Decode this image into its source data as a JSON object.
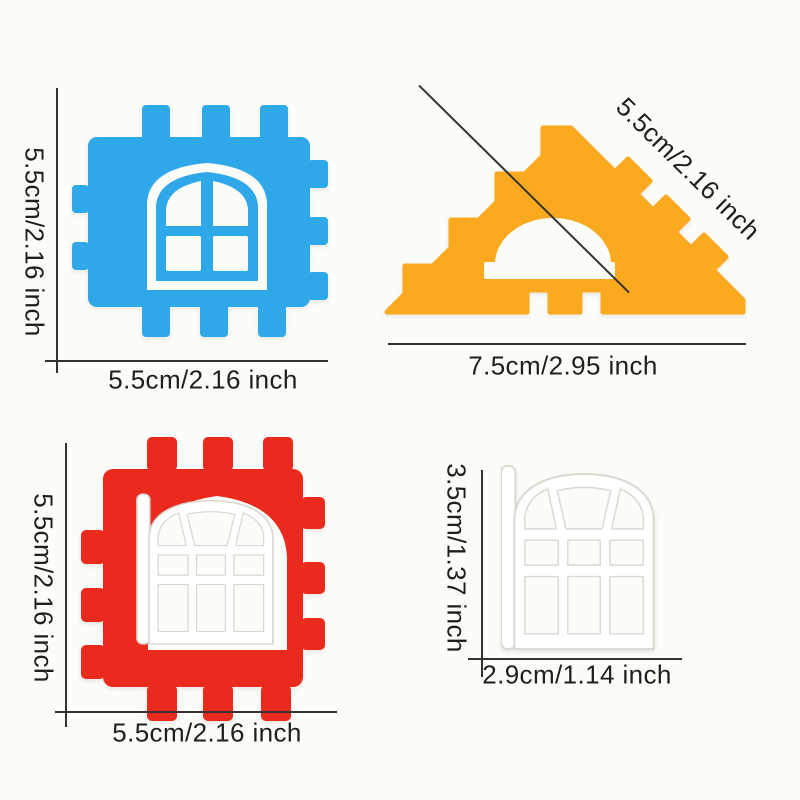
{
  "page": {
    "background": "#fcfcf8",
    "annotation_line_color": "#333333",
    "annotation_text_color": "#1f1f1f"
  },
  "pieces": {
    "blue_block": {
      "name": "Blue castellated window block",
      "color": "#2fa8e9",
      "height_label": "5.5cm/2.16 inch",
      "width_label": "5.5cm/2.16 inch"
    },
    "orange_triangle": {
      "name": "Orange castellated roof triangle",
      "color": "#fba91e",
      "slant_label": "5.5cm/2.16 inch",
      "width_label": "7.5cm/2.95 inch"
    },
    "red_block": {
      "name": "Red castellated window block",
      "color": "#e92a1d",
      "height_label": "5.5cm/2.16 inch",
      "width_label": "5.5cm/2.16 inch"
    },
    "white_window": {
      "name": "White window frame",
      "color": "#ffffff",
      "height_label": "3.5cm/1.37 inch",
      "width_label": "2.9cm/1.14 inch"
    }
  }
}
